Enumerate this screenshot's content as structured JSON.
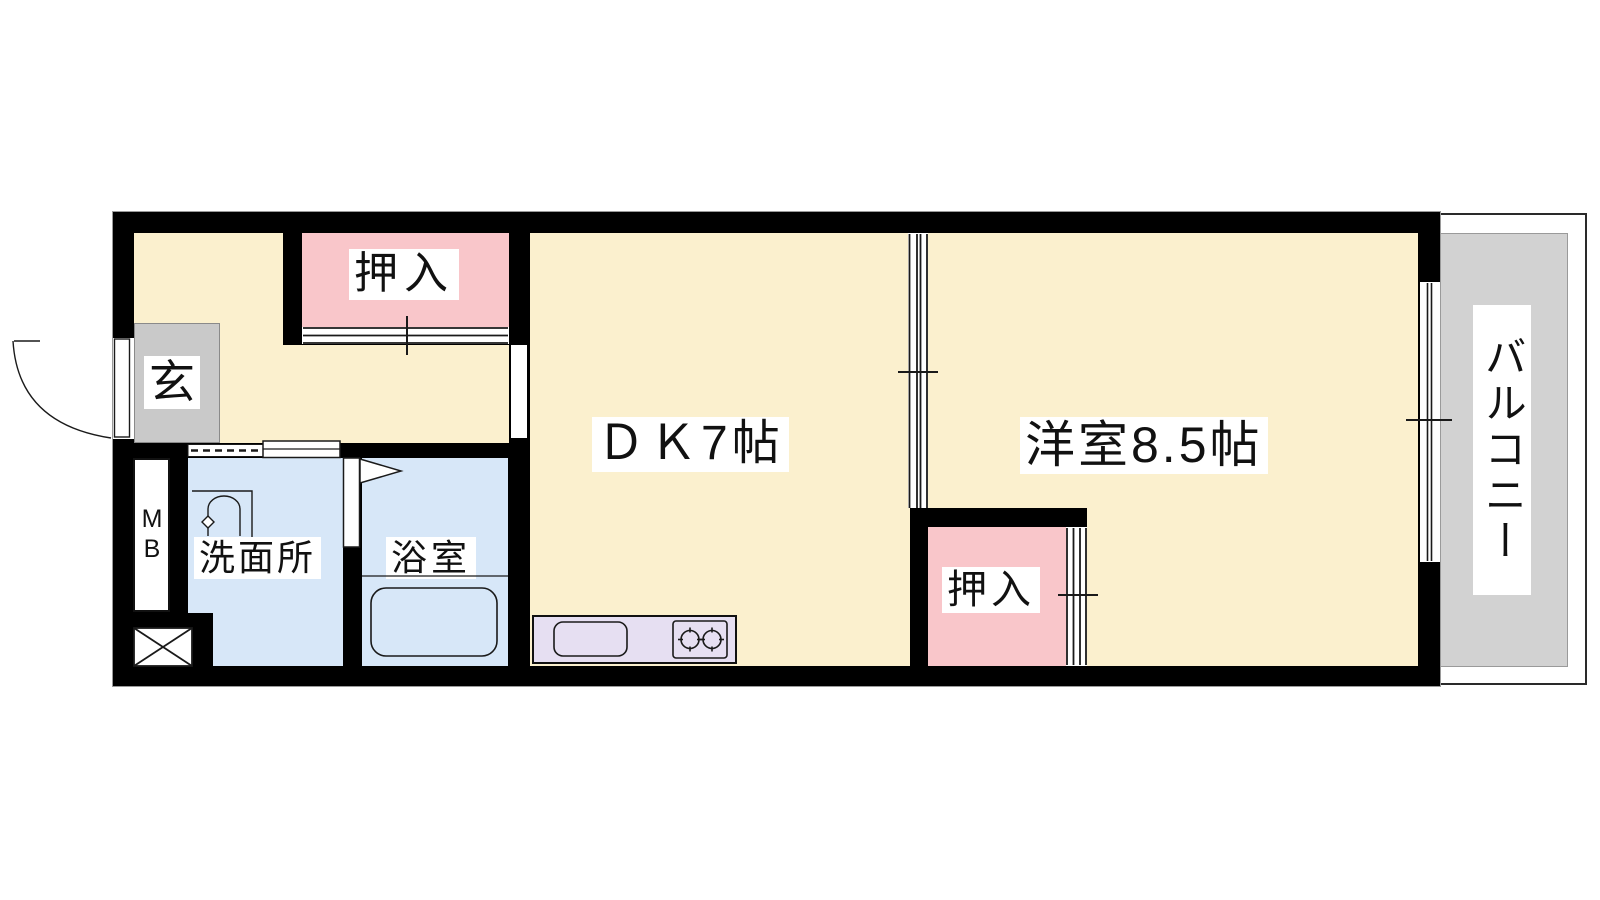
{
  "plan": {
    "type": "apartment-floor-plan",
    "rooms": {
      "closet_top": "押入",
      "entrance": "玄",
      "meter_box": "MB",
      "washroom": "洗面所",
      "bathroom": "浴室",
      "dining_kitchen": "ＤＫ7帖",
      "western_room": "洋室8.5帖",
      "closet_bottom": "押入",
      "balcony": "バルコニー"
    },
    "colors": {
      "wall": "#000000",
      "room_floor": "#FBF0CE",
      "closet_floor": "#F9C6CA",
      "wet_area_floor": "#D7E7F8",
      "kitchen_counter": "#E6DFF2",
      "entrance_floor": "#C9C9C9",
      "balcony_floor": "#D2D2D2",
      "label_background": "#FFFFFF",
      "label_text": "#111111"
    }
  }
}
